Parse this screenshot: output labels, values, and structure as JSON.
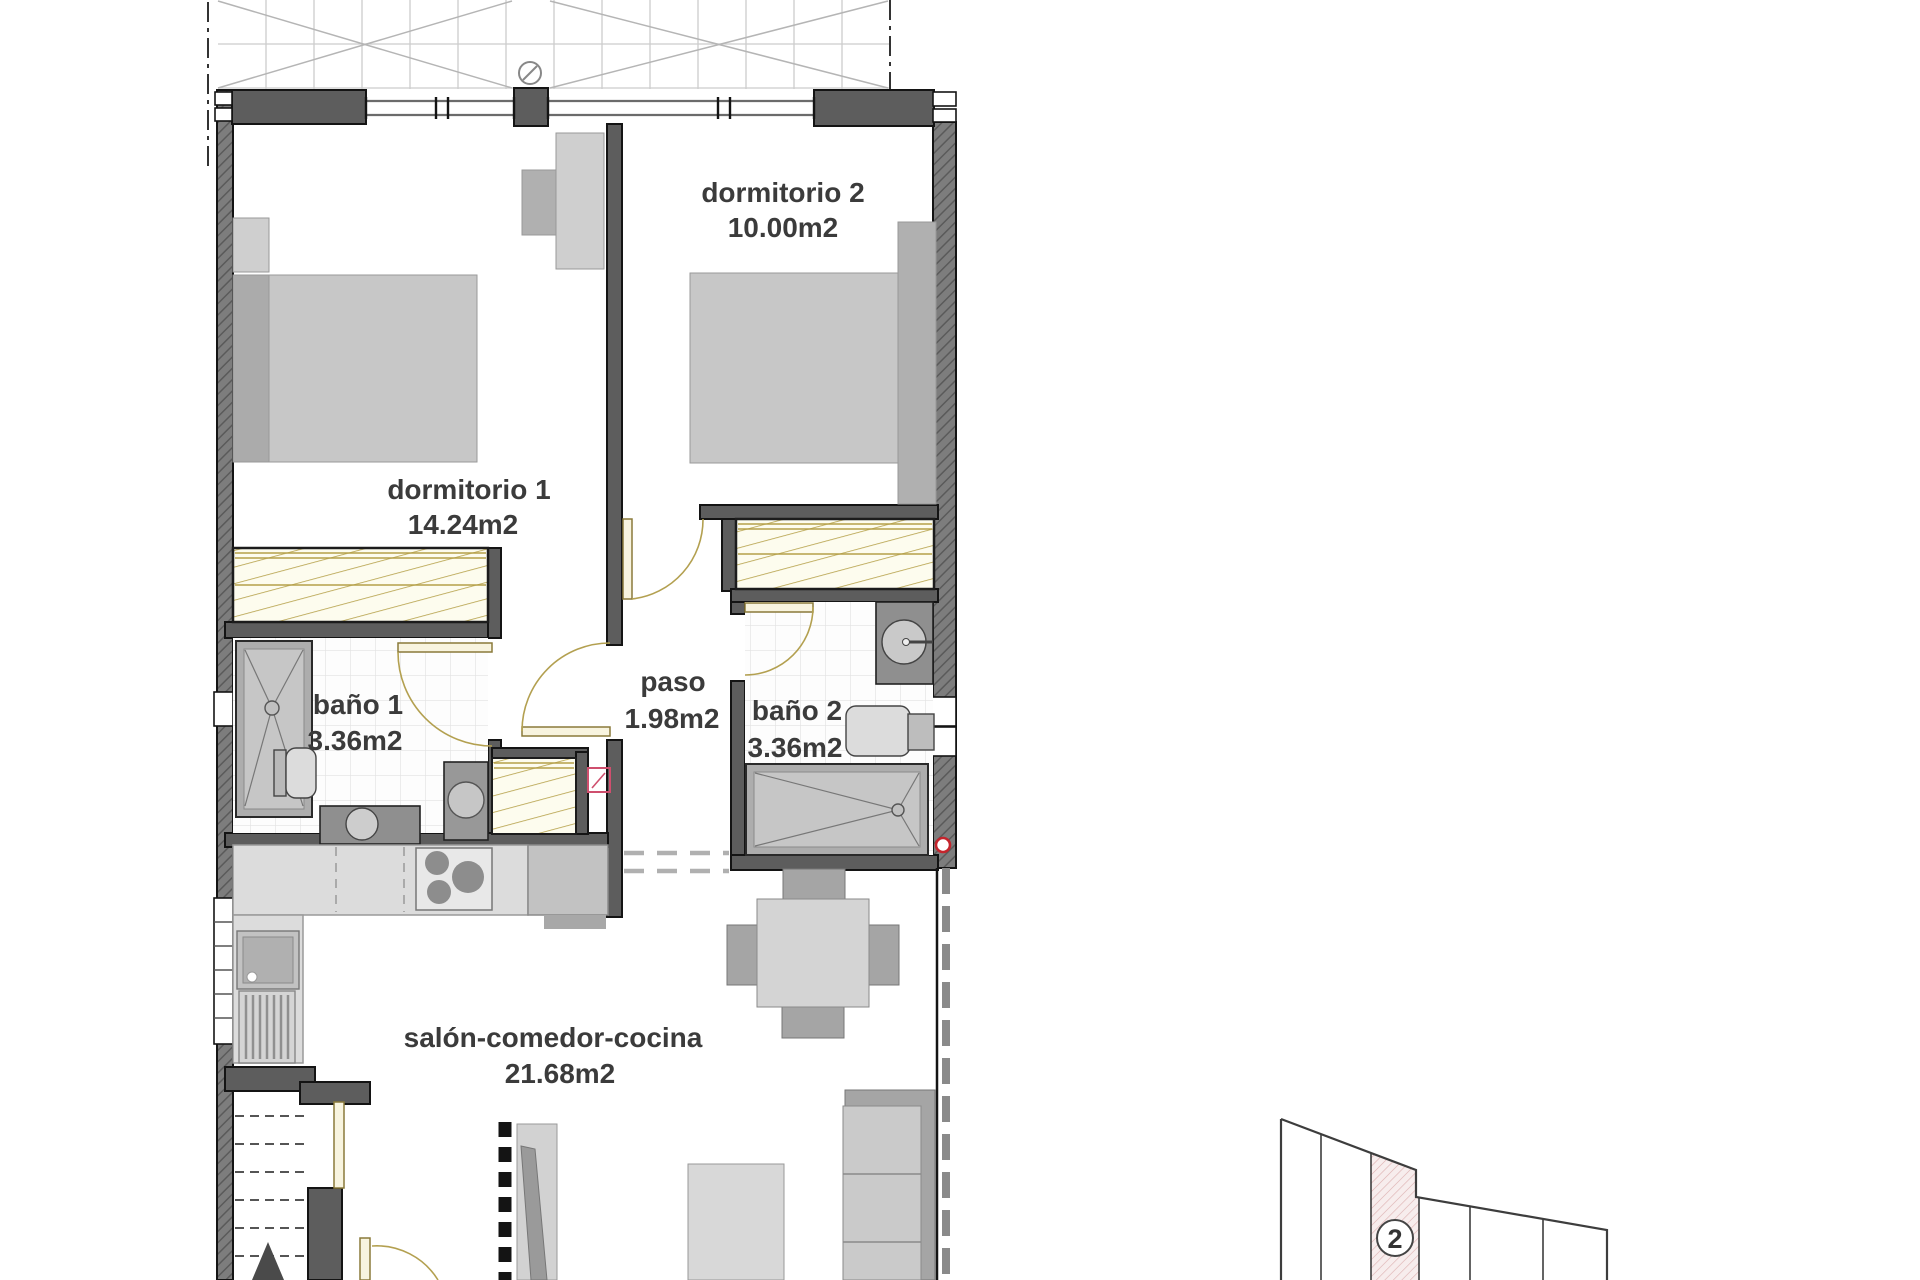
{
  "plan": {
    "rooms": [
      {
        "name": "dormitorio 2",
        "area": "10.00m2"
      },
      {
        "name": "dormitorio 1",
        "area": "14.24m2"
      },
      {
        "name": "baño 1",
        "area": "3.36m2"
      },
      {
        "name": "paso",
        "area": "1.98m2"
      },
      {
        "name": "baño 2",
        "area": "3.36m2"
      },
      {
        "name": "salón-comedor-cocina",
        "area": "21.68m2"
      }
    ]
  },
  "site_plan": {
    "unit_number": "2"
  },
  "colors": {
    "wall_dark": "#5d5d5d",
    "door_tan": "#b3a050",
    "unit_highlight_pink": "#f7eded",
    "marker_red": "#c4242c"
  }
}
